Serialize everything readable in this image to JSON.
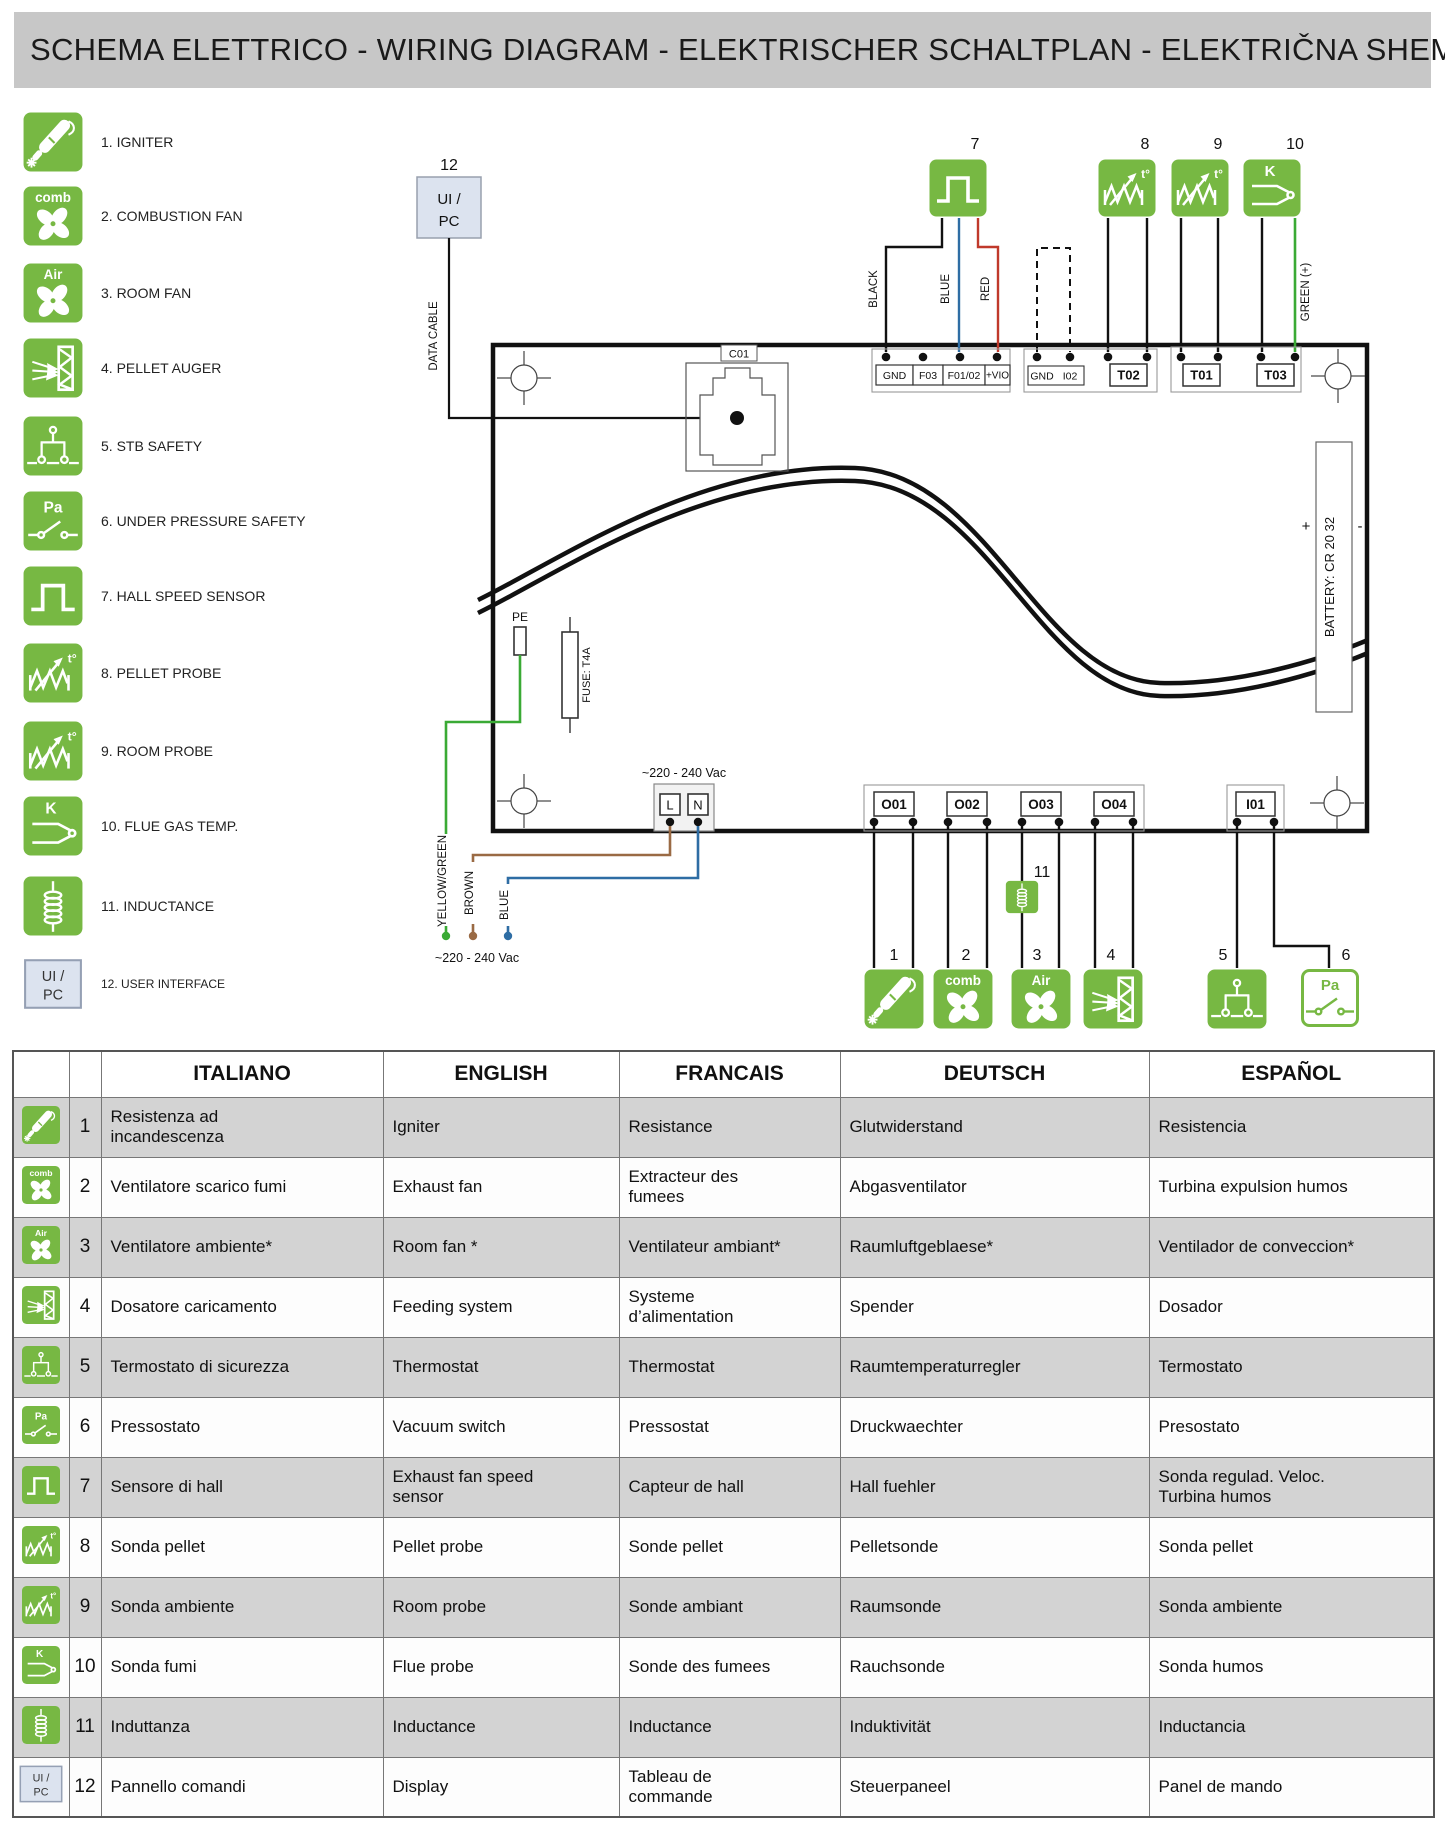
{
  "title": "SCHEMA ELETTRICO - WIRING DIAGRAM - ELEKTRISCHER SCHALTPLAN - ELEKTRIČNA SHEMA",
  "colors": {
    "green": "#77b843",
    "title_bg": "#c7c7c7",
    "row_gray": "#d3d3d3",
    "ui_box_bg": "#dce3ef",
    "wire_black": "#111111",
    "wire_blue": "#2e6da4",
    "wire_red": "#c0392b",
    "wire_green": "#3aaa35",
    "wire_brown": "#9a6a44"
  },
  "icons": {
    "fan_comb": "comb",
    "fan_air": "Air",
    "pa": "Pa",
    "k": "K",
    "temp": "t°",
    "ui_line1": "UI /",
    "ui_line2": "PC"
  },
  "legend": {
    "items": [
      {
        "icon": "igniter",
        "label": "1. IGNITER"
      },
      {
        "icon": "fan_comb",
        "label": "2. COMBUSTION FAN"
      },
      {
        "icon": "fan_air",
        "label": "3. ROOM FAN"
      },
      {
        "icon": "auger",
        "label": "4. PELLET AUGER"
      },
      {
        "icon": "stb",
        "label": "5. STB SAFETY"
      },
      {
        "icon": "pa",
        "label": "6. UNDER PRESSURE SAFETY"
      },
      {
        "icon": "hall",
        "label": "7. HALL SPEED SENSOR"
      },
      {
        "icon": "probe",
        "label": "8. PELLET PROBE"
      },
      {
        "icon": "probe",
        "label": "9. ROOM PROBE"
      },
      {
        "icon": "k",
        "label": "10. FLUE GAS TEMP."
      },
      {
        "icon": "inductance",
        "label": "11. INDUCTANCE"
      },
      {
        "icon": "ui",
        "label": "12. USER INTERFACE"
      }
    ]
  },
  "diagram": {
    "ui_pc_num": "12",
    "data_cable": "DATA CABLE",
    "c01": "C01",
    "pe": "PE",
    "fuse": "FUSE: T4A",
    "mains": "~220 - 240 Vac",
    "l": "L",
    "n": "N",
    "battery": "BATTERY: CR 20 32",
    "plus": "+",
    "minus": "-",
    "wire_black": "BLACK",
    "wire_blue": "BLUE",
    "wire_red": "RED",
    "wire_green": "GREEN (+)",
    "wire_yg": "YELLOW/GREEN",
    "wire_brown": "BROWN",
    "wire_blue2": "BLUE",
    "strip1": [
      "GND",
      "F03",
      "F01/02",
      "+VIO"
    ],
    "strip2": [
      "GND",
      "I02"
    ],
    "t02": "T02",
    "t01": "T01",
    "t03": "T03",
    "outputs": [
      "O01",
      "O02",
      "O03",
      "O04"
    ],
    "i01": "I01",
    "devices": [
      {
        "num": "7",
        "icon": "hall"
      },
      {
        "num": "8",
        "icon": "probe"
      },
      {
        "num": "9",
        "icon": "probe"
      },
      {
        "num": "10",
        "icon": "k"
      },
      {
        "num": "1",
        "icon": "igniter"
      },
      {
        "num": "2",
        "icon": "fan_comb"
      },
      {
        "num": "3",
        "icon": "fan_air"
      },
      {
        "num": "4",
        "icon": "auger"
      },
      {
        "num": "5",
        "icon": "stb"
      },
      {
        "num": "6",
        "icon": "pa_out"
      },
      {
        "num": "11",
        "icon": "inductance"
      }
    ]
  },
  "table": {
    "headers": [
      "ITALIANO",
      "ENGLISH",
      "FRANCAIS",
      "DEUTSCH",
      "ESPAÑOL"
    ],
    "rows": [
      {
        "num": "1",
        "icon": "igniter",
        "it": "Resistenza ad\nincandescenza",
        "en": "Igniter",
        "fr": "Resistance",
        "de": "Glutwiderstand",
        "es": "Resistencia"
      },
      {
        "num": "2",
        "icon": "fan_comb",
        "it": "Ventilatore scarico fumi",
        "en": "Exhaust fan",
        "fr": "Extracteur des\nfumees",
        "de": "Abgasventilator",
        "es": "Turbina expulsion humos"
      },
      {
        "num": "3",
        "icon": "fan_air",
        "it": "Ventilatore ambiente*",
        "en": "Room fan *",
        "fr": "Ventilateur ambiant*",
        "de": "Raumluftgeblaese*",
        "es": "Ventilador de conveccion*"
      },
      {
        "num": "4",
        "icon": "auger",
        "it": "Dosatore caricamento",
        "en": "Feeding system",
        "fr": "Systeme\nd’alimentation",
        "de": "Spender",
        "es": "Dosador"
      },
      {
        "num": "5",
        "icon": "stb",
        "it": "Termostato di sicurezza",
        "en": "Thermostat",
        "fr": "Thermostat",
        "de": "Raumtemperaturregler",
        "es": "Termostato"
      },
      {
        "num": "6",
        "icon": "pa",
        "it": "Pressostato",
        "en": "Vacuum switch",
        "fr": "Pressostat",
        "de": "Druckwaechter",
        "es": "Presostato"
      },
      {
        "num": "7",
        "icon": "hall",
        "it": "Sensore di hall",
        "en": "Exhaust fan speed\nsensor",
        "fr": "Capteur de hall",
        "de": "Hall fuehler",
        "es": "Sonda regulad. Veloc.\nTurbina humos"
      },
      {
        "num": "8",
        "icon": "probe",
        "it": "Sonda pellet",
        "en": "Pellet probe",
        "fr": "Sonde pellet",
        "de": "Pelletsonde",
        "es": "Sonda pellet"
      },
      {
        "num": "9",
        "icon": "probe",
        "it": "Sonda ambiente",
        "en": "Room probe",
        "fr": "Sonde ambiant",
        "de": "Raumsonde",
        "es": "Sonda ambiente"
      },
      {
        "num": "10",
        "icon": "k",
        "it": "Sonda fumi",
        "en": "Flue probe",
        "fr": "Sonde des fumees",
        "de": "Rauchsonde",
        "es": "Sonda humos"
      },
      {
        "num": "11",
        "icon": "inductance",
        "it": "Induttanza",
        "en": "Inductance",
        "fr": "Inductance",
        "de": "Induktivität",
        "es": "Inductancia"
      },
      {
        "num": "12",
        "icon": "ui",
        "it": "Pannello comandi",
        "en": "Display",
        "fr": "Tableau de\ncommande",
        "de": "Steuerpaneel",
        "es": "Panel de mando"
      }
    ]
  }
}
